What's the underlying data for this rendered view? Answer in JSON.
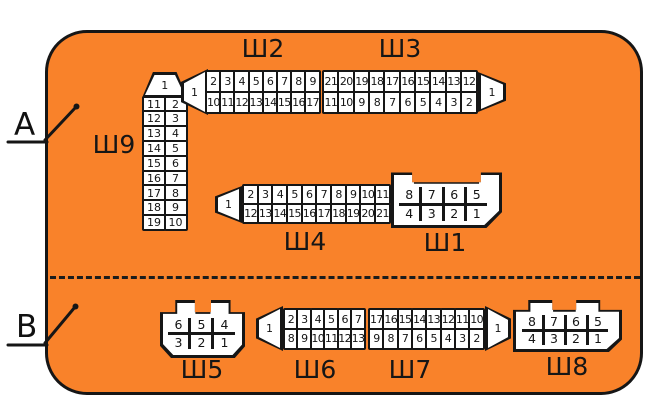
{
  "panel": {
    "fill_color": "#f9822a",
    "outline_color": "#161616",
    "cell_color": "#ffffff"
  },
  "zone_labels": {
    "top": "A",
    "bottom": "B"
  },
  "connectors": {
    "sh9": {
      "label": "Ш9",
      "entry_pin": "1",
      "left_column": [
        "11",
        "12",
        "13",
        "14",
        "15",
        "16",
        "17",
        "18",
        "19"
      ],
      "right_column": [
        "2",
        "3",
        "4",
        "5",
        "6",
        "7",
        "8",
        "9",
        "10"
      ]
    },
    "sh2": {
      "label": "Ш2",
      "entry_pin": "1",
      "top_row": [
        "2",
        "3",
        "4",
        "5",
        "6",
        "7",
        "8",
        "9"
      ],
      "bottom_row": [
        "10",
        "11",
        "12",
        "13",
        "14",
        "15",
        "16",
        "17"
      ]
    },
    "sh3": {
      "label": "Ш3",
      "exit_pin": "1",
      "top_row": [
        "21",
        "20",
        "19",
        "18",
        "17",
        "16",
        "15",
        "14",
        "13",
        "12"
      ],
      "bottom_row": [
        "11",
        "10",
        "9",
        "8",
        "7",
        "6",
        "5",
        "4",
        "3",
        "2"
      ]
    },
    "sh4": {
      "label": "Ш4",
      "entry_pin": "1",
      "top_row": [
        "2",
        "3",
        "4",
        "5",
        "6",
        "7",
        "8",
        "9",
        "10",
        "11"
      ],
      "bottom_row": [
        "12",
        "13",
        "14",
        "15",
        "16",
        "17",
        "18",
        "19",
        "20",
        "21"
      ]
    },
    "sh1": {
      "label": "Ш1",
      "top_row": [
        "8",
        "7",
        "6",
        "5"
      ],
      "bottom_row": [
        "4",
        "3",
        "2",
        "1"
      ]
    },
    "sh5": {
      "label": "Ш5",
      "top_row": [
        "6",
        "5",
        "4"
      ],
      "bottom_row": [
        "3",
        "2",
        "1"
      ]
    },
    "sh6": {
      "label": "Ш6",
      "entry_pin": "1",
      "top_row": [
        "2",
        "3",
        "4",
        "5",
        "6",
        "7"
      ],
      "bottom_row": [
        "8",
        "9",
        "10",
        "11",
        "12",
        "13"
      ]
    },
    "sh7": {
      "label": "Ш7",
      "exit_pin": "1",
      "top_row": [
        "17",
        "16",
        "15",
        "14",
        "13",
        "12",
        "11",
        "10"
      ],
      "bottom_row": [
        "9",
        "8",
        "7",
        "6",
        "5",
        "4",
        "3",
        "2"
      ]
    },
    "sh8": {
      "label": "Ш8",
      "top_row": [
        "8",
        "7",
        "6",
        "5"
      ],
      "bottom_row": [
        "4",
        "3",
        "2",
        "1"
      ]
    }
  }
}
